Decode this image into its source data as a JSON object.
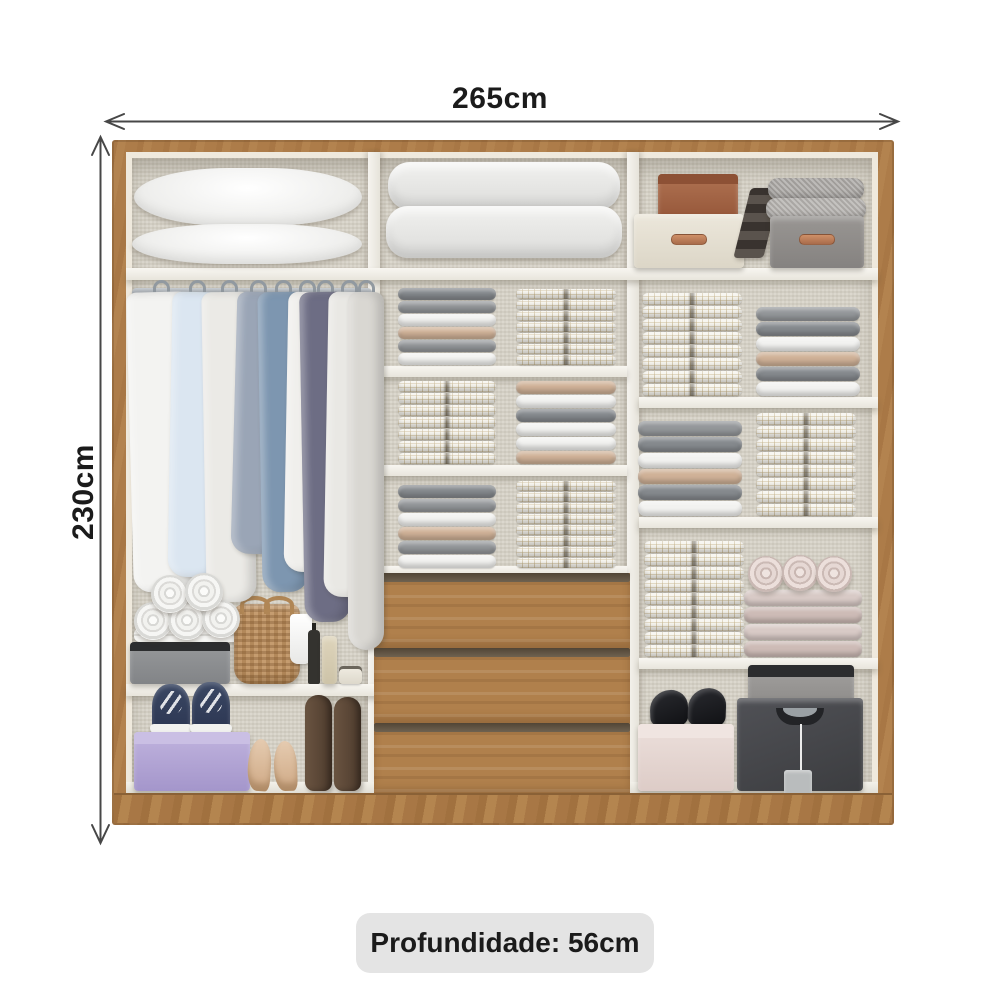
{
  "labels": {
    "width": "265cm",
    "height": "230cm",
    "depth": "Profundidade: 56cm"
  },
  "dimensions": {
    "width_cm": 265,
    "height_cm": 230,
    "depth_cm": 56
  },
  "colors": {
    "wood": "#ad7c49",
    "wood_dark": "#8a6136",
    "interior_back": "#d7d3c8",
    "shelf_white": "#f2f0ea",
    "arrow": "#474747",
    "label_text": "#1b1b1b",
    "label_bg": "#e4e4e4",
    "drawer_wood": "#b0804c",
    "drawer_groove": "#675a48",
    "purple_shoe_box": "#b3a5d6",
    "wicker_basket": "#c59c6f",
    "charcoal_box": "#47484b",
    "pink_box": "#e7d9d5",
    "cream_box": "#e6e1d5",
    "terracotta_box": "#a5674a",
    "gray_box": "#908d8b",
    "navy_sneaker": "#2f3b58",
    "boot_brown": "#5c4839",
    "heel_beige": "#d9bb9f"
  },
  "fold_colors": {
    "g1": "#85898d",
    "g2": "#94979a",
    "w": "#f2f2f0",
    "t": "#cfb197",
    "p": "#d8cac6",
    "p2": "#cdbbb6"
  },
  "stacks": [
    {
      "x": 272,
      "bottom": 214,
      "w": 98,
      "fh": 12,
      "folds": [
        "g1",
        "g2",
        "w",
        "t",
        "g2",
        "w"
      ]
    },
    {
      "x": 390,
      "bottom": 214,
      "w": 100,
      "fh": 10,
      "folds": [
        "c",
        "c",
        "c",
        "c",
        "c",
        "c",
        "c"
      ]
    },
    {
      "x": 272,
      "bottom": 313,
      "w": 98,
      "fh": 11,
      "folds": [
        "c",
        "c",
        "c",
        "c",
        "c",
        "c",
        "c"
      ]
    },
    {
      "x": 390,
      "bottom": 313,
      "w": 100,
      "fh": 13,
      "folds": [
        "t",
        "w",
        "g1",
        "w",
        "w",
        "t"
      ]
    },
    {
      "x": 272,
      "bottom": 417,
      "w": 98,
      "fh": 13,
      "folds": [
        "g1",
        "g2",
        "w",
        "t",
        "g2",
        "w"
      ]
    },
    {
      "x": 390,
      "bottom": 417,
      "w": 100,
      "fh": 10,
      "folds": [
        "c",
        "c",
        "c",
        "c",
        "c",
        "c",
        "c",
        "c"
      ]
    },
    {
      "x": 516,
      "bottom": 245,
      "w": 100,
      "fh": 12,
      "folds": [
        "c",
        "c",
        "c",
        "c",
        "c",
        "c",
        "c",
        "c"
      ]
    },
    {
      "x": 630,
      "bottom": 245,
      "w": 104,
      "fh": 14,
      "folds": [
        "g2",
        "g1",
        "w",
        "t",
        "g1",
        "w"
      ]
    },
    {
      "x": 512,
      "bottom": 365,
      "w": 104,
      "fh": 15,
      "folds": [
        "g2",
        "g1",
        "w",
        "t",
        "g1",
        "w"
      ]
    },
    {
      "x": 630,
      "bottom": 365,
      "w": 100,
      "fh": 12,
      "folds": [
        "c",
        "c",
        "c",
        "c",
        "c",
        "c",
        "c",
        "c"
      ]
    },
    {
      "x": 518,
      "bottom": 506,
      "w": 100,
      "fh": 12,
      "folds": [
        "c",
        "c",
        "c",
        "c",
        "c",
        "c",
        "c",
        "c",
        "c"
      ]
    },
    {
      "x": 618,
      "bottom": 506,
      "w": 118,
      "fh": 16,
      "folds": [
        "p",
        "p2",
        "p",
        "p2"
      ]
    }
  ],
  "garments": [
    {
      "x": 4,
      "w": 62,
      "h": 300,
      "c": "#f3f3f1",
      "pat": "plain",
      "tilt": -1.5
    },
    {
      "x": 44,
      "w": 54,
      "h": 285,
      "c": "#cddcee",
      "pat": "gingham",
      "tilt": 1
    },
    {
      "x": 78,
      "w": 50,
      "h": 310,
      "c": "#ebeae6",
      "pat": "plain",
      "tilt": -1
    },
    {
      "x": 108,
      "w": 48,
      "h": 262,
      "c": "#9aa5b6",
      "pat": "plain",
      "tilt": 1.5
    },
    {
      "x": 134,
      "w": 46,
      "h": 300,
      "c": "#7d96b0",
      "pat": "plain",
      "tilt": -1
    },
    {
      "x": 160,
      "w": 42,
      "h": 280,
      "c": "#f0efec",
      "pat": "plain",
      "tilt": 1
    },
    {
      "x": 176,
      "w": 46,
      "h": 330,
      "c": "#6d6d84",
      "pat": "plain",
      "tilt": -1
    },
    {
      "x": 200,
      "w": 46,
      "h": 305,
      "c": "#e9e8e4",
      "pat": "plain",
      "tilt": 1
    },
    {
      "x": 222,
      "w": 36,
      "h": 358,
      "c": "#d9d7d2",
      "pat": "plain",
      "tilt": 0
    }
  ],
  "rolls": {
    "white": [
      {
        "x": 8,
        "y": 450,
        "d": 38
      },
      {
        "x": 42,
        "y": 450,
        "d": 38
      },
      {
        "x": 76,
        "y": 448,
        "d": 38
      },
      {
        "x": 25,
        "y": 423,
        "d": 38
      },
      {
        "x": 59,
        "y": 421,
        "d": 38
      }
    ],
    "pink": [
      {
        "x": 622,
        "y": 404,
        "d": 36
      },
      {
        "x": 656,
        "y": 403,
        "d": 36
      },
      {
        "x": 690,
        "y": 404,
        "d": 36
      }
    ]
  }
}
